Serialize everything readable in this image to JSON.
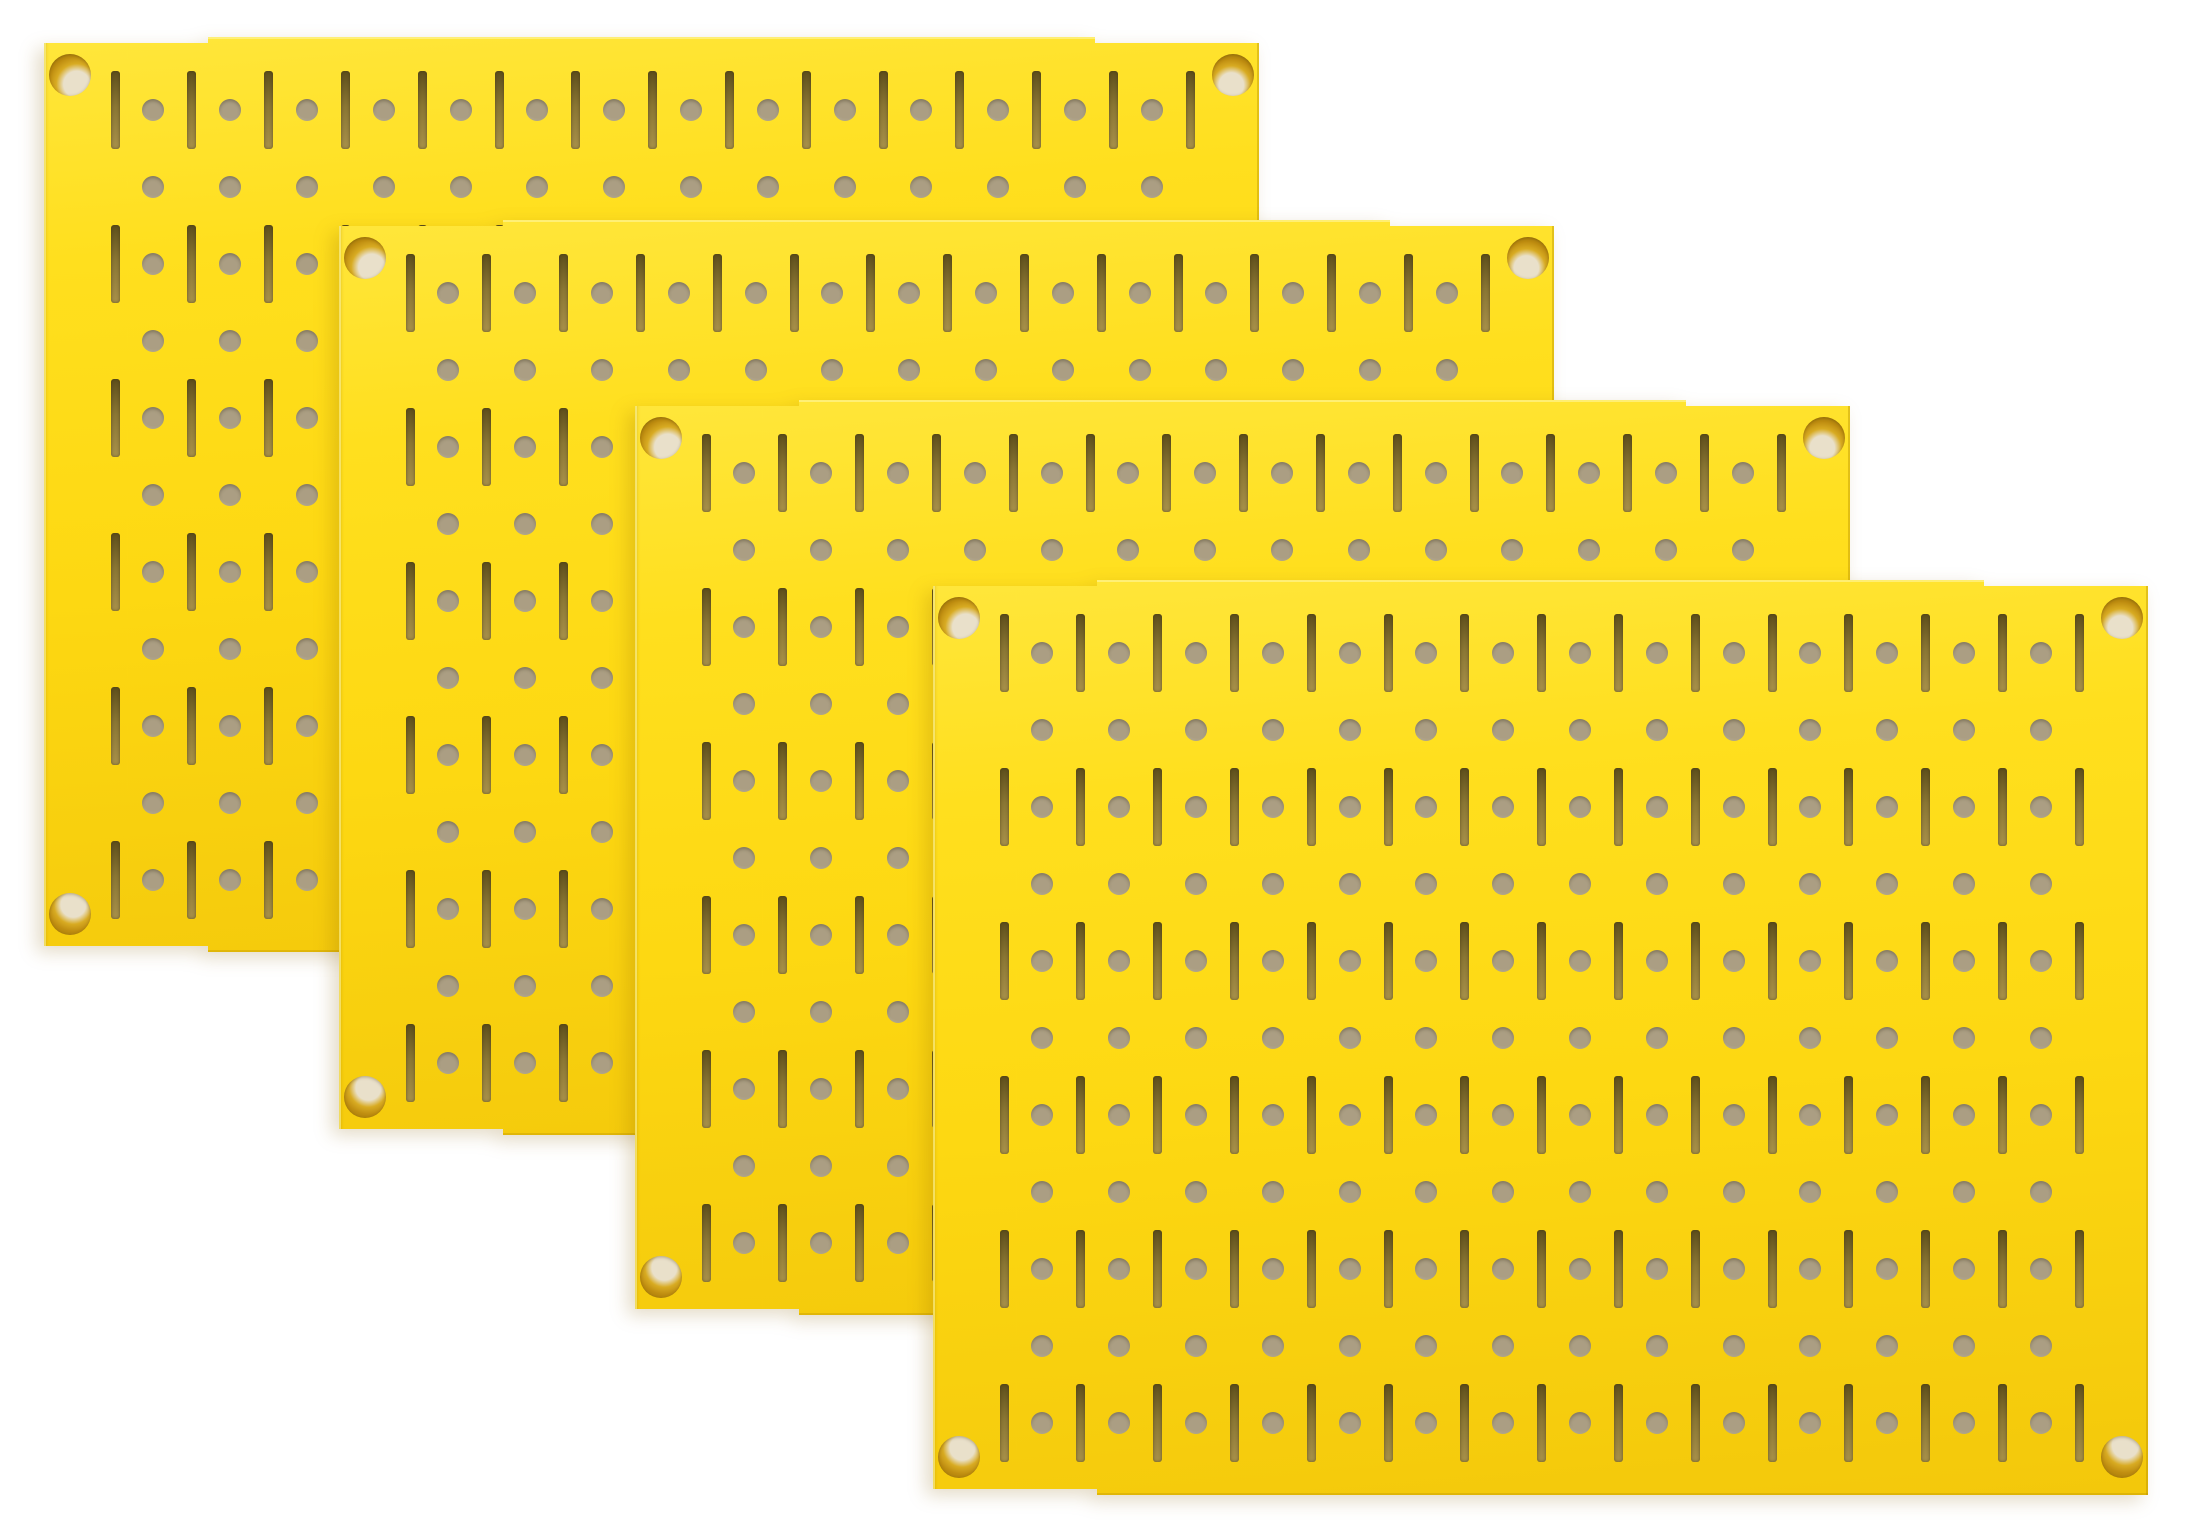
{
  "scene": {
    "width": 2189,
    "height": 1530,
    "background": "#ffffff"
  },
  "panel": {
    "width": 1215,
    "height": 915,
    "edge_step": {
      "inset": 164,
      "depth": 6
    },
    "surface": {
      "top": "#ffe63b",
      "upper": "#ffdf1e",
      "mid": "#fdd812",
      "bottom": "#f3c80b"
    },
    "pattern": {
      "col_pitch": 76.8,
      "row_pitch": 77,
      "slot_col_first": 71,
      "slot_col_count": 15,
      "hole_col_first": 109.4,
      "hole_col_count": 14,
      "row_first": 73,
      "row_count": 11,
      "slot_row_indices": [
        0,
        2,
        4,
        6,
        8,
        10
      ],
      "slot": {
        "width": 9,
        "height": 78,
        "radius": 3,
        "color_top": "#5e4f1c",
        "color_mid": "#8a7634",
        "color_bottom": "#a8914a"
      },
      "hole": {
        "diameter": 22,
        "color": "#ab9e83",
        "color_edge": "#948769"
      }
    },
    "corner_hole": {
      "radius": 21,
      "inset_x": 26,
      "inset_y": 38,
      "amber": "#bf8d10",
      "amber_dark": "#9a7408",
      "amber_mid": "#d8ab22",
      "cream": "#e9e0ca",
      "blob_center_percent": {
        "tl": [
          66,
          72
        ],
        "tr": [
          46,
          74
        ],
        "bl": [
          58,
          28
        ],
        "br": [
          58,
          22
        ]
      }
    }
  },
  "panels": [
    {
      "index": 1,
      "x": 44,
      "y": 37,
      "z": 1
    },
    {
      "index": 2,
      "x": 339,
      "y": 220,
      "z": 2
    },
    {
      "index": 3,
      "x": 635,
      "y": 400,
      "z": 3
    },
    {
      "index": 4,
      "x": 933,
      "y": 580,
      "z": 4
    }
  ]
}
